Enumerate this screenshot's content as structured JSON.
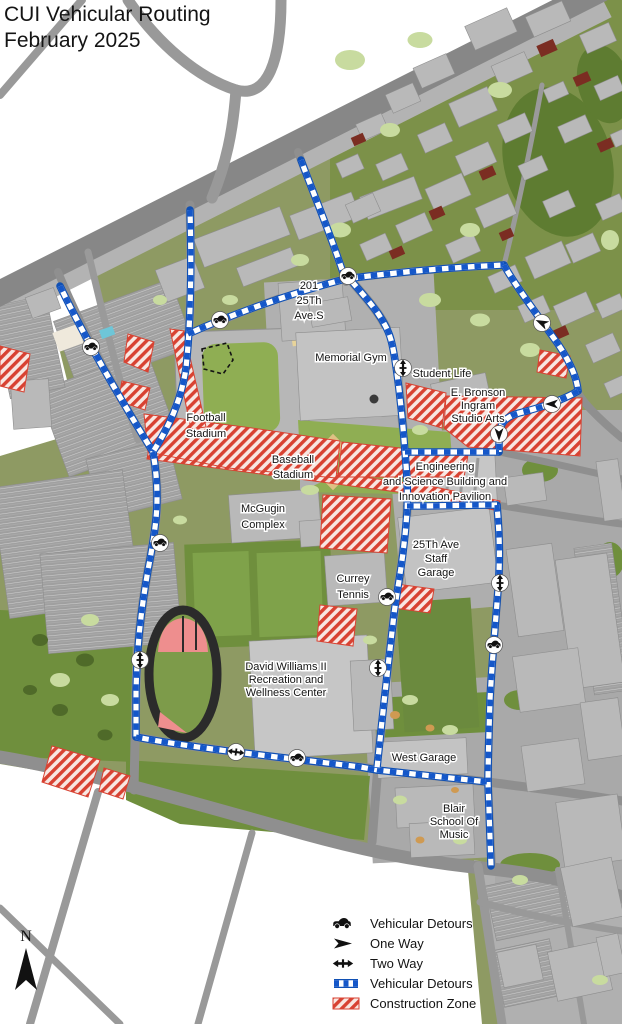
{
  "title": {
    "line1": "CUI Vehicular Routing",
    "line2": "February 2025"
  },
  "compass": {
    "label": "N"
  },
  "legend": {
    "items": [
      {
        "icon": "car-detour-icon",
        "label": "Vehicular Detours"
      },
      {
        "icon": "one-way-icon",
        "label": "One Way"
      },
      {
        "icon": "two-way-icon",
        "label": "Two Way"
      },
      {
        "icon": "route-line-icon",
        "label": "Vehicular Detours"
      },
      {
        "icon": "construction-zone-icon",
        "label": "Construction Zone"
      }
    ]
  },
  "colors": {
    "route_blue": "#1557c9",
    "construction_red": "#d84232",
    "road_gray": "#8a8a8a",
    "building_gray": "#b9b9b9",
    "campus_olive": "#8e9a63",
    "lawn_green": "#5e7c31",
    "field_green": "#8fae53"
  },
  "map": {
    "labels": [
      {
        "id": "201-25th-ave-s",
        "x": 309,
        "y": 289,
        "dy": 15,
        "lines": [
          "201",
          "25Th",
          "Ave.S"
        ]
      },
      {
        "id": "memorial-gym",
        "x": 351,
        "y": 361,
        "dy": 13,
        "lines": [
          "Memorial Gym"
        ]
      },
      {
        "id": "student-life",
        "x": 442,
        "y": 377,
        "dy": 13,
        "lines": [
          "Student Life"
        ]
      },
      {
        "id": "e-bronson-ingram",
        "x": 478,
        "y": 396,
        "dy": 13,
        "lines": [
          "E. Bronson",
          "Ingram",
          "Studio Arts"
        ]
      },
      {
        "id": "football-stadium",
        "x": 206,
        "y": 421,
        "dy": 16,
        "lines": [
          "Football",
          "Stadium"
        ]
      },
      {
        "id": "baseball-stadium",
        "x": 293,
        "y": 463,
        "dy": 15,
        "lines": [
          "Baseball",
          "Stadium"
        ]
      },
      {
        "id": "engineering",
        "x": 445,
        "y": 470,
        "dy": 15,
        "lines": [
          "Engineering",
          "and Science Building and",
          "Innovation Pavilion"
        ]
      },
      {
        "id": "mcgugin-complex",
        "x": 263,
        "y": 512,
        "dy": 16,
        "lines": [
          "McGugin",
          "Complex"
        ]
      },
      {
        "id": "25th-ave-garage",
        "x": 436,
        "y": 548,
        "dy": 14,
        "lines": [
          "25Th Ave",
          "Staff",
          "Garage"
        ]
      },
      {
        "id": "currey-tennis",
        "x": 353,
        "y": 582,
        "dy": 16,
        "lines": [
          "Currey",
          "Tennis"
        ]
      },
      {
        "id": "david-williams",
        "x": 286,
        "y": 670,
        "dy": 13,
        "lines": [
          "David Williams II",
          "Recreation and",
          "Wellness Center"
        ]
      },
      {
        "id": "west-garage",
        "x": 424,
        "y": 761,
        "dy": 13,
        "lines": [
          "West Garage"
        ]
      },
      {
        "id": "blair-music",
        "x": 454,
        "y": 812,
        "dy": 13,
        "lines": [
          "Blair",
          "School Of",
          "Music"
        ]
      }
    ],
    "markers": [
      {
        "type": "car",
        "x": 91,
        "y": 347,
        "angle": 0
      },
      {
        "type": "car",
        "x": 220,
        "y": 320,
        "angle": 0
      },
      {
        "type": "car",
        "x": 348,
        "y": 276,
        "angle": 0
      },
      {
        "type": "car",
        "x": 160,
        "y": 543,
        "angle": 0
      },
      {
        "type": "car",
        "x": 387,
        "y": 597,
        "angle": 0
      },
      {
        "type": "car",
        "x": 494,
        "y": 645,
        "angle": 0
      },
      {
        "type": "car",
        "x": 297,
        "y": 758,
        "angle": 0
      },
      {
        "type": "oneway",
        "x": 542,
        "y": 323,
        "angle": 205
      },
      {
        "type": "oneway",
        "x": 552,
        "y": 404,
        "angle": 180
      },
      {
        "type": "oneway",
        "x": 499,
        "y": 434,
        "angle": 90
      },
      {
        "type": "twoway",
        "x": 403,
        "y": 368,
        "angle": 90
      },
      {
        "type": "twoway",
        "x": 500,
        "y": 583,
        "angle": 90
      },
      {
        "type": "twoway",
        "x": 140,
        "y": 660,
        "angle": 90
      },
      {
        "type": "twoway",
        "x": 378,
        "y": 668,
        "angle": 90
      },
      {
        "type": "twoway",
        "x": 236,
        "y": 752,
        "angle": 8
      }
    ]
  }
}
